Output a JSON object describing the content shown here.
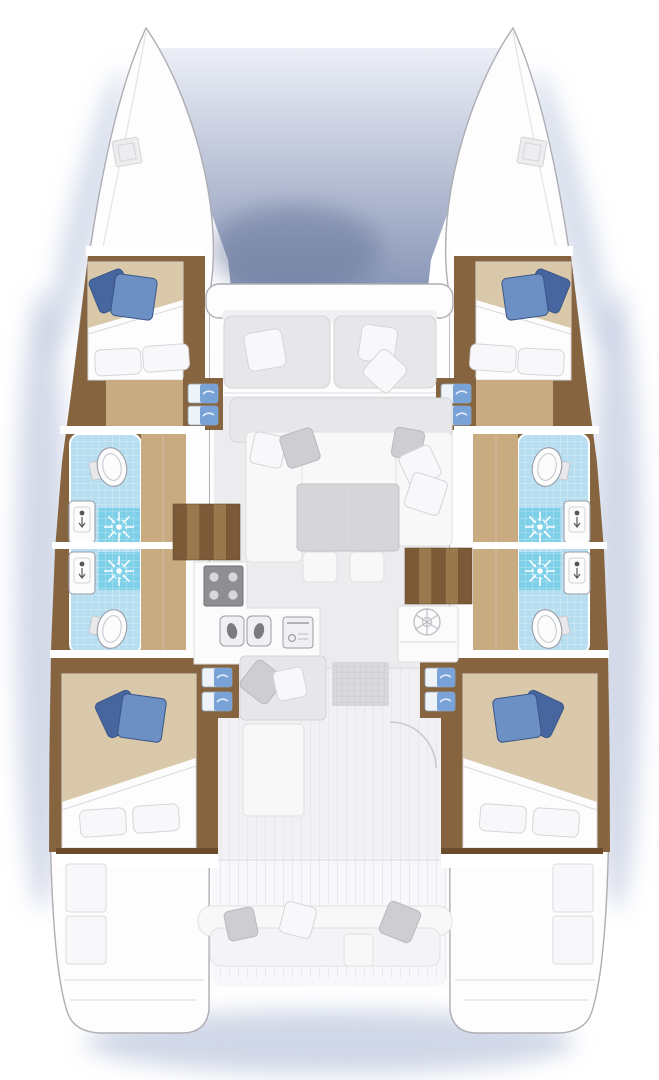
{
  "diagram": {
    "type": "floor-plan",
    "subject": "catamaran sailing yacht interior layout",
    "view": "top-down",
    "layout": "4 cabins, 4 bathrooms, salon with galley, forward and aft cockpits",
    "hulls": [
      "port",
      "starboard"
    ],
    "areas": [
      {
        "id": "port-bow-locker",
        "items": [
          "deck-hatch"
        ]
      },
      {
        "id": "starboard-bow-locker",
        "items": [
          "deck-hatch"
        ]
      },
      {
        "id": "foredeck-trampoline",
        "items": []
      },
      {
        "id": "forward-cockpit",
        "items": [
          "bench-2-cushions",
          "3-throw-pillows"
        ]
      },
      {
        "id": "port-forward-cabin",
        "items": [
          "double-berth",
          "2-blue-pillows",
          "2-white-pillows",
          "entry-steps"
        ]
      },
      {
        "id": "starboard-forward-cabin",
        "items": [
          "double-berth",
          "2-blue-pillows",
          "2-white-pillows",
          "entry-steps"
        ]
      },
      {
        "id": "port-forward-bathroom",
        "items": [
          "toilet",
          "washbasin",
          "shower"
        ]
      },
      {
        "id": "port-aft-bathroom",
        "items": [
          "toilet",
          "washbasin",
          "shower"
        ]
      },
      {
        "id": "starboard-forward-bathroom",
        "items": [
          "toilet",
          "washbasin",
          "shower"
        ]
      },
      {
        "id": "starboard-aft-bathroom",
        "items": [
          "toilet",
          "washbasin",
          "shower"
        ]
      },
      {
        "id": "salon",
        "items": [
          "u-shaped-sofa",
          "dining-table",
          "2-stools",
          "throw-pillows"
        ]
      },
      {
        "id": "galley",
        "items": [
          "4-burner-stove",
          "double-sink",
          "oven",
          "round-sink-unit"
        ]
      },
      {
        "id": "port-hull-companionway",
        "items": [
          "5-steps"
        ]
      },
      {
        "id": "starboard-hull-companionway",
        "items": [
          "5-steps"
        ]
      },
      {
        "id": "aft-passage",
        "items": [
          "chaise-lounge",
          "door-swing-arc",
          "floor-mat"
        ]
      },
      {
        "id": "port-aft-cabin",
        "items": [
          "double-berth",
          "2-blue-pillows",
          "2-white-pillows",
          "entry-steps"
        ]
      },
      {
        "id": "starboard-aft-cabin",
        "items": [
          "double-berth",
          "2-blue-pillows",
          "2-white-pillows",
          "entry-steps"
        ]
      },
      {
        "id": "aft-cockpit",
        "items": [
          "curved-bench",
          "3-throw-pillows",
          "center-seat"
        ]
      },
      {
        "id": "port-transom-steps",
        "items": []
      },
      {
        "id": "starboard-transom-steps",
        "items": []
      }
    ]
  },
  "colors": {
    "page_bg": "#ffffff",
    "shadow_blue": "#a9b6d4",
    "shadow_dark": "#606f95",
    "tramp_top": "#eceff7",
    "tramp_bottom": "#8a97b7",
    "hull_white": "#fdfdfe",
    "hull_stroke": "#adadb3",
    "deck_white": "#f8f8fa",
    "deck_floor": "#f1f1f4",
    "plank_line": "#e3e3e7",
    "wall_white": "#ffffff",
    "soft_stroke": "#d9d9dd",
    "wood": "#86643f",
    "wood_edge": "#6a4c2c",
    "wood_slat_a": "#7b5a37",
    "wood_slat_b": "#99784d",
    "wood_floor": "#c9ab81",
    "duvet": "#d9c8a9",
    "mattress": "#fdfdfe",
    "pillow_white": "#f8f8fa",
    "pillow_stroke": "#d6d6da",
    "pillow_gray": "#cdcdd2",
    "pillow_gray_edge": "#b9b9bf",
    "pillow_blue": "#6d90c4",
    "pillow_blue_dark": "#47659e",
    "pillow_blue_edge": "#3b5688",
    "step_blue": "#79a3d6",
    "step_tread": "#eef3fa",
    "step_tread_stroke": "#8fa3b8",
    "tile_blue": "#b6def0",
    "shower_blue": "#7ecfe8",
    "fixture": "#fcfcfd",
    "fixture_stroke": "#9a9da6",
    "salon_floor": "#ececee",
    "sofa": "#f8f8f9",
    "sofa_stroke": "#e1e1e4",
    "cushion": "#e7e7ea",
    "cushion_stroke": "#d4d4d8",
    "table": "#d6d6d9",
    "table_stroke": "#c3c3c8",
    "counter": "#fbfbfc",
    "counter_stroke": "#dcdce0",
    "appliance": "#f0f0f2",
    "appliance_dark": "#55565c",
    "mat": "#d9d9dd",
    "mat_line": "#c5c5ca"
  }
}
